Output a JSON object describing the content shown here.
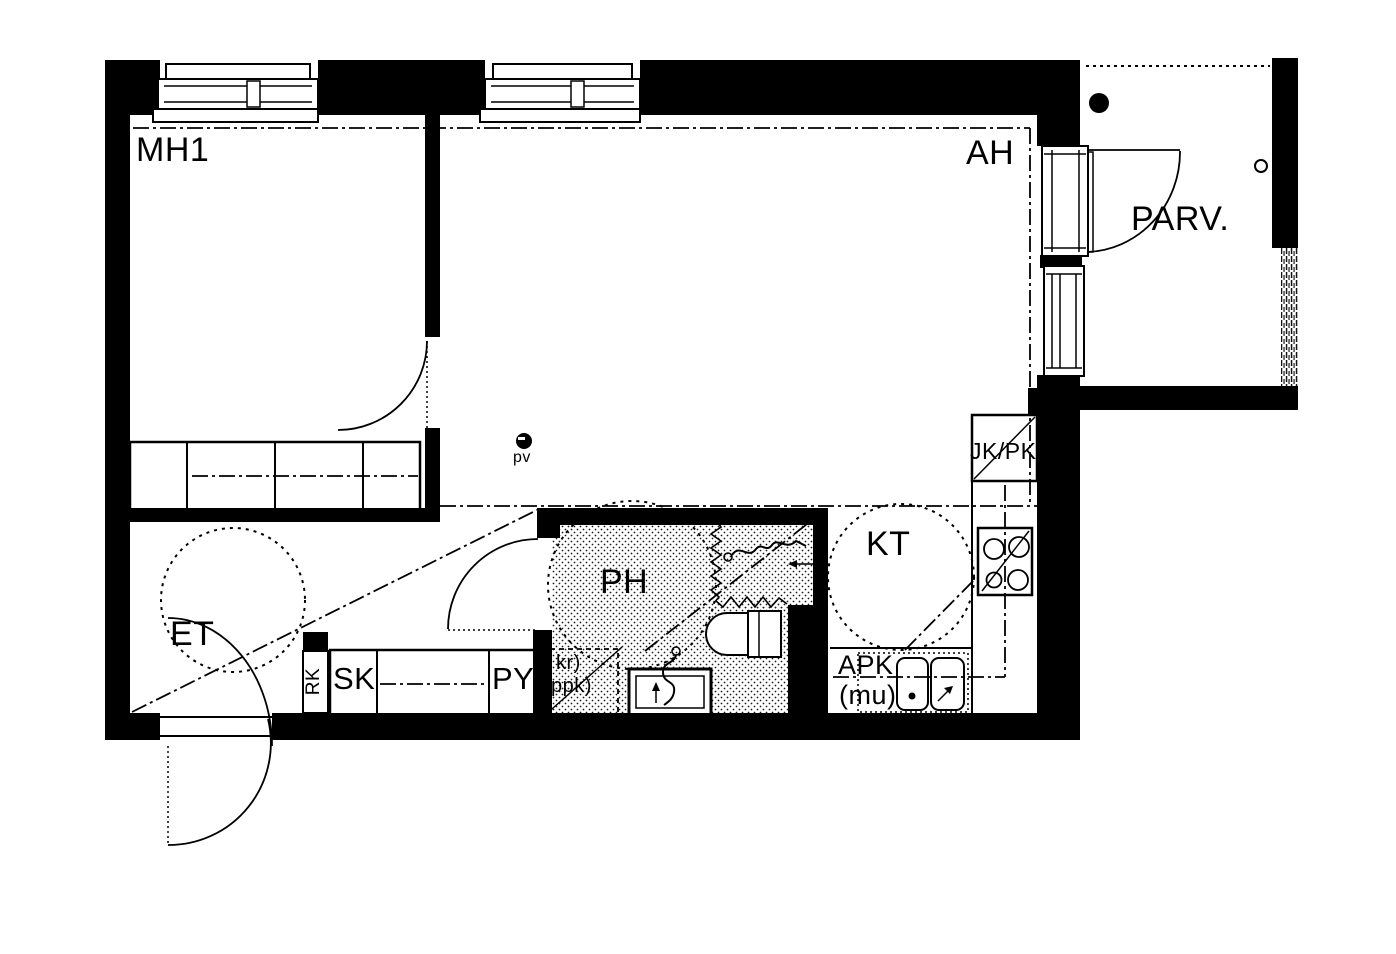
{
  "floorplan": {
    "rooms": {
      "bedroom": "MH1",
      "living_room": "AH",
      "balcony": "PARV.",
      "entry": "ET",
      "bathroom": "PH",
      "kitchen": "KT"
    },
    "fixtures": {
      "cleaning_closet": "SK",
      "closet_py": "PY",
      "electrical_panel": "RK",
      "fridge_freezer": "JK/PK",
      "dishwasher_reservation": "APK",
      "dishwasher_note": "(mu)",
      "dryer_note": "kr)",
      "washer_note": "ppk)",
      "water_point": "pv"
    },
    "colors": {
      "ink": "#000000",
      "paper": "#ffffff"
    }
  }
}
